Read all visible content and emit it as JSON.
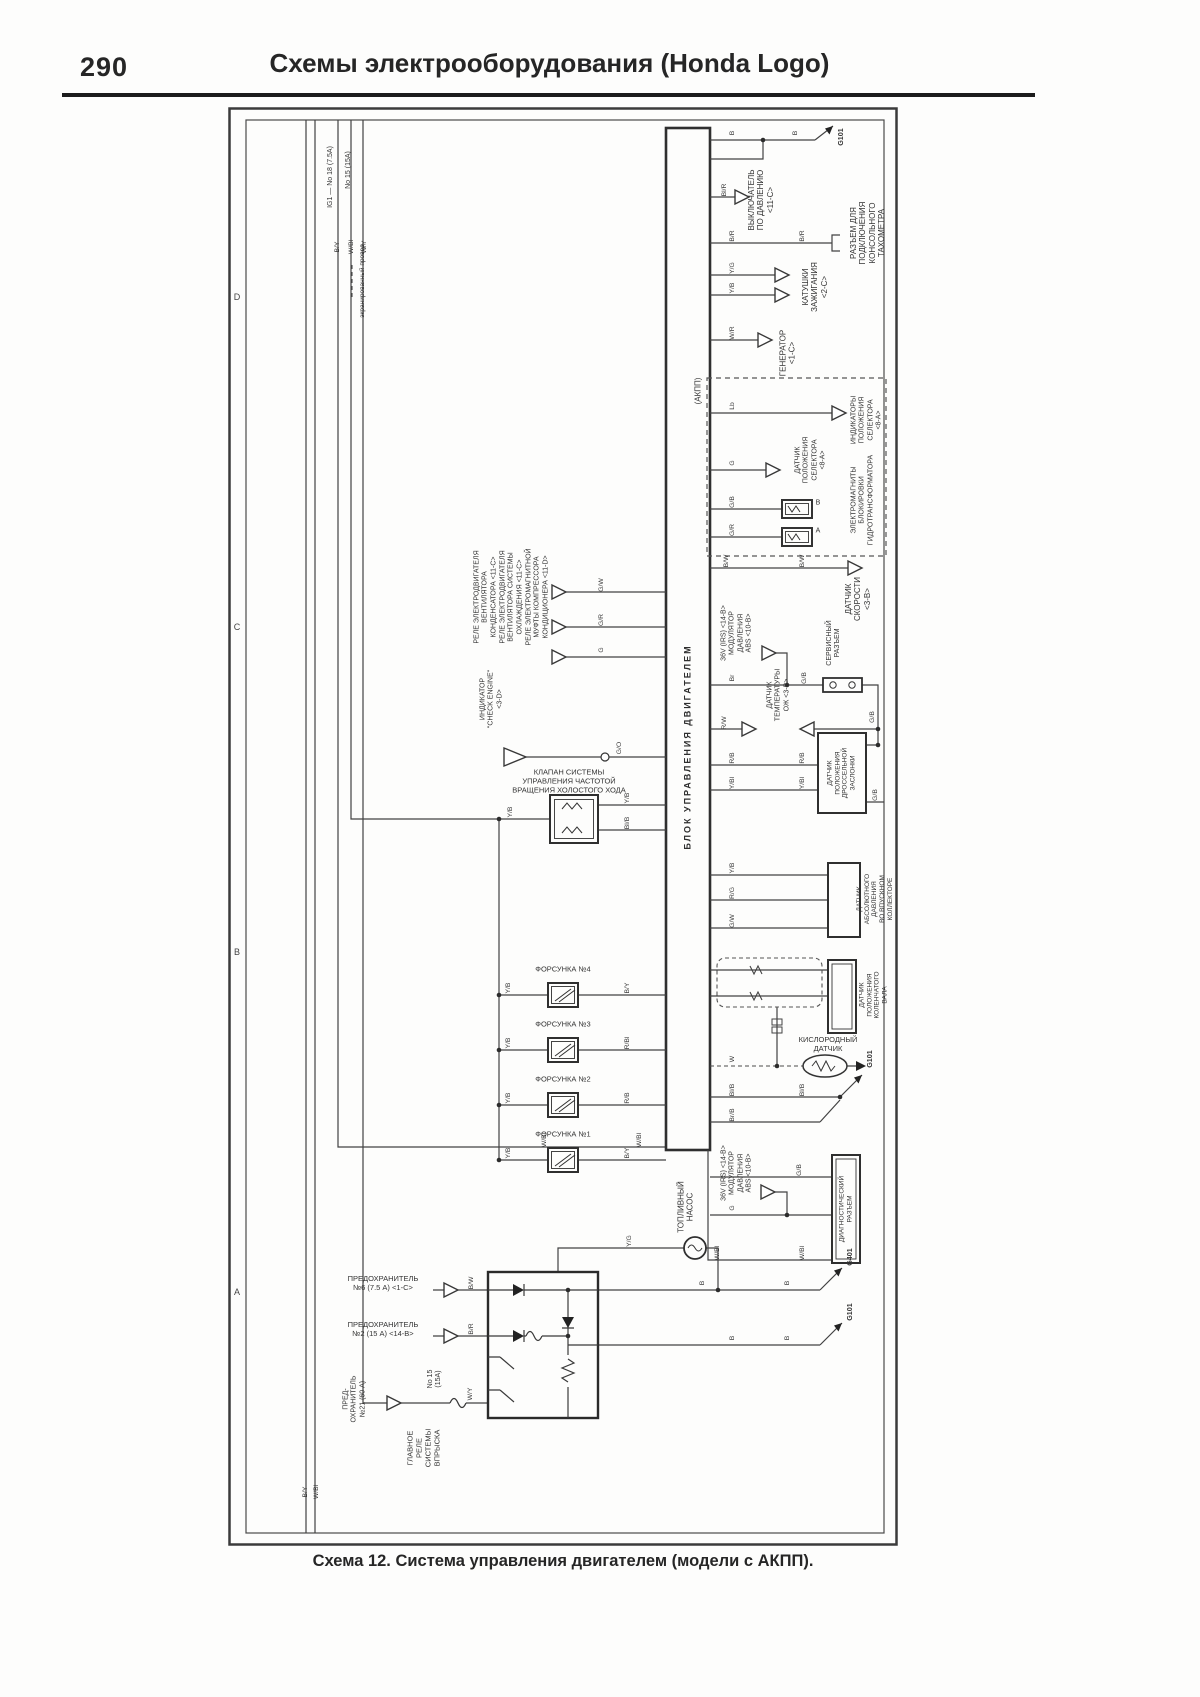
{
  "page": {
    "number": "290",
    "title": "Схемы электрооборудования (Honda Logo)",
    "caption": "Схема 12. Система управления двигателем (модели с АКПП)."
  },
  "zones": {
    "d": "D",
    "c": "C",
    "b": "B",
    "a": "A"
  },
  "bus": {
    "t1": "IG1 — No 18 (7.5A)",
    "t2": "No 15 (15A)"
  },
  "legend": "экранированный провод",
  "ecu": "БЛОК УПРАВЛЕНИЯ ДВИГАТЕЛЕМ",
  "grounds": {
    "g101": "G101",
    "g401": "G401"
  },
  "letters": {
    "a": "A",
    "b": "B"
  },
  "wires": {
    "b": "B",
    "by": "B/Y",
    "bw": "B/W",
    "br": "B/R",
    "blr": "Bl/R",
    "blb": "Bl/B",
    "brb": "Br/B",
    "brn": "Br",
    "w": "W",
    "wr": "W/R",
    "wy": "W/Y",
    "wbl": "W/Bl",
    "yg": "Y/G",
    "yb": "Y/B",
    "ybl": "Y/Bl",
    "g": "G",
    "gb": "G/B",
    "gr": "G/R",
    "gw": "G/W",
    "go": "G/O",
    "rb": "R/B",
    "rbl": "R/Bl",
    "rg": "R/G",
    "rw": "R/W",
    "lb": "Lb"
  },
  "components": {
    "pressure_switch": "ВЫКЛЮЧАТЕЛЬ\nПО ДАВЛЕНИЮ\n<11-C>",
    "tach_connector": "РАЗЪЕМ ДЛЯ\nПОДКЛЮЧЕНИЯ\nКОНСОЛЬНОГО\nТАХОМЕТРА",
    "ign_coils": "КАТУШКИ\nЗАЖИГАНИЯ\n<2-C>",
    "generator": "ГЕНЕРАТОР\n<1-C>",
    "at_box": "(АКПП)",
    "sel_indicators": "ИНДИКАТОРЫ\nПОЛОЖЕНИЯ\nСЕЛЕКТОРА\n<8-A>",
    "sel_sensor": "ДАТЧИК\nПОЛОЖЕНИЯ\nСЕЛЕКТОРА\n<8-A>",
    "lock_solenoids": "ЭЛЕКТРОМАГНИТЫ\nБЛОКИРОВКИ\nГИДРОТРАНСФОРМАТОРА",
    "speed_sensor": "ДАТЧИК\nСКОРОСТИ\n<3-B>",
    "abs_mod": "36V (IRS) <14-B>\nМОДУЛЯТОР\nДАВЛЕНИЯ\nABS <10-B>",
    "service_conn": "СЕРВИСНЫЙ\nРАЗЪЕМ",
    "coolant_temp": "ДАТЧИК\nТЕМПЕРАТУРЫ\nОЖ <3-B>",
    "tps": "ДАТЧИК\nПОЛОЖЕНИЯ\nДРОССЕЛЬНОЙ\nЗАСЛОНКИ",
    "map_sensor": "ДАТЧИК\nАБСОЛЮТНОГО\nДАВЛЕНИЯ\nВО ВПУСКНОМ\nКОЛЛЕКТОРЕ",
    "crank_sensor": "ДАТЧИК\nПОЛОЖЕНИЯ\nКОЛЕНЧАТОГО\nВАЛА",
    "o2_sensor": "КИСЛОРОДНЫЙ\nДАТЧИК",
    "diag_conn": "ДИАГНОСТИЧЕСКИЙ\nРАЗЪЕМ",
    "fuel_pump": "ТОПЛИВНЫЙ\nНАСОС",
    "check_engine": "ИНДИКАТОР\n\"CHECK ENGINE\"\n<3-D>",
    "iacv": "КЛАПАН СИСТЕМЫ\nУПРАВЛЕНИЯ ЧАСТОТОЙ\nВРАЩЕНИЯ ХОЛОСТОГО ХОДА",
    "relay_cond_fan": "РЕЛЕ ЭЛЕКТРОДВИГАТЕЛЯ\nВЕНТИЛЯТОРА\nКОНДЕНСАТОРА <11-C>",
    "relay_cool_fan": "РЕЛЕ ЭЛЕКТРОДВИГАТЕЛЯ\nВЕНТИЛЯТОРА СИСТЕМЫ\nОХЛАЖДЕНИЯ <11-C>",
    "relay_ac": "РЕЛЕ ЭЛЕКТРОМАГНИТНОЙ\nМУФТЫ КОМПРЕССОРА\nКОНДИЦИОНЕРА <11-D>",
    "inj4": "ФОРСУНКА №4",
    "inj3": "ФОРСУНКА №3",
    "inj2": "ФОРСУНКА №2",
    "inj1": "ФОРСУНКА №1",
    "fuse6": "ПРЕДОХРАНИТЕЛЬ\n№6 (7.5 А) <1-C>",
    "fuse2": "ПРЕДОХРАНИТЕЛЬ\n№2 (15 А) <14-B>",
    "fuse21": "ПРЕД-\nОХРАНИТЕЛЬ\n№21 (60 А)",
    "no15": "No 15\n(15A)",
    "main_relay": "ГЛАВНОЕ\nРЕЛЕ\nСИСТЕМЫ\nВПРЫСКА"
  }
}
